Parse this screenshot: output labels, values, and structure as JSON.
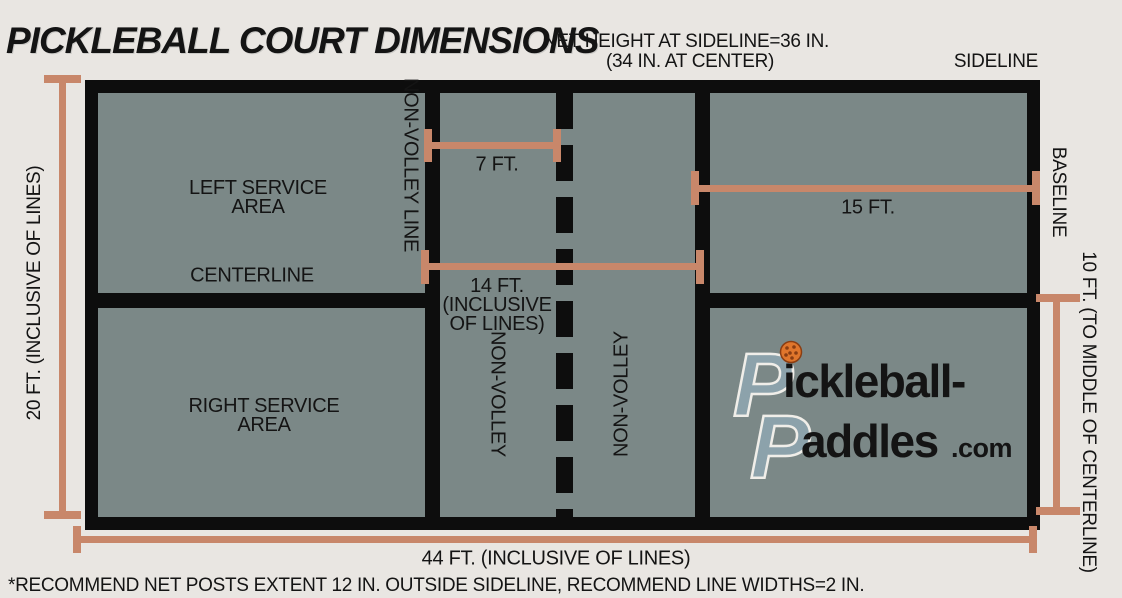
{
  "page": {
    "title": "PICKLEBALL COURT DIMENSIONS",
    "footnote": "*RECOMMEND NET POSTS EXTENT 12 IN. OUTSIDE SIDELINE, RECOMMEND LINE WIDTHS=2 IN."
  },
  "annotations": {
    "net_height_line1": "NET HEIGHT AT SIDELINE=36 IN.",
    "net_height_line2": "(34 IN. AT CENTER)",
    "sideline": "SIDELINE",
    "baseline": "BASELINE"
  },
  "court": {
    "left_service_line1": "LEFT SERVICE",
    "left_service_line2": "AREA",
    "right_service_line1": "RIGHT SERVICE",
    "right_service_line2": "AREA",
    "centerline": "CENTERLINE",
    "non_volley_line": "NON-VOLLEY LINE",
    "non_volley_left": "NON-VOLLEY",
    "non_volley_right": "NON-VOLLEY"
  },
  "measurements": {
    "court_width": "20 FT. (INCLUSIVE OF LINES)",
    "non_volley_depth": "7 FT.",
    "service_depth": "15 FT.",
    "kitchen_total_line1": "14 FT.",
    "kitchen_total_line2": "(INCLUSIVE",
    "kitchen_total_line3": "OF LINES)",
    "half_court": "10 FT. (TO MIDDLE OF CENTERLINE)",
    "court_length": "44 FT. (INCLUSIVE OF LINES)"
  },
  "logo": {
    "line1_initial": "P",
    "line1_rest": "ickleball-",
    "line2_initial": "P",
    "line2_rest": "addles",
    "suffix": ".com"
  },
  "colors": {
    "background": "#e9e6e2",
    "court_fill": "#7b8887",
    "court_lines": "#0d0d0d",
    "measurement": "#c8876a",
    "logo_initial": "#8ca2ab",
    "ball": "#e0762c"
  }
}
